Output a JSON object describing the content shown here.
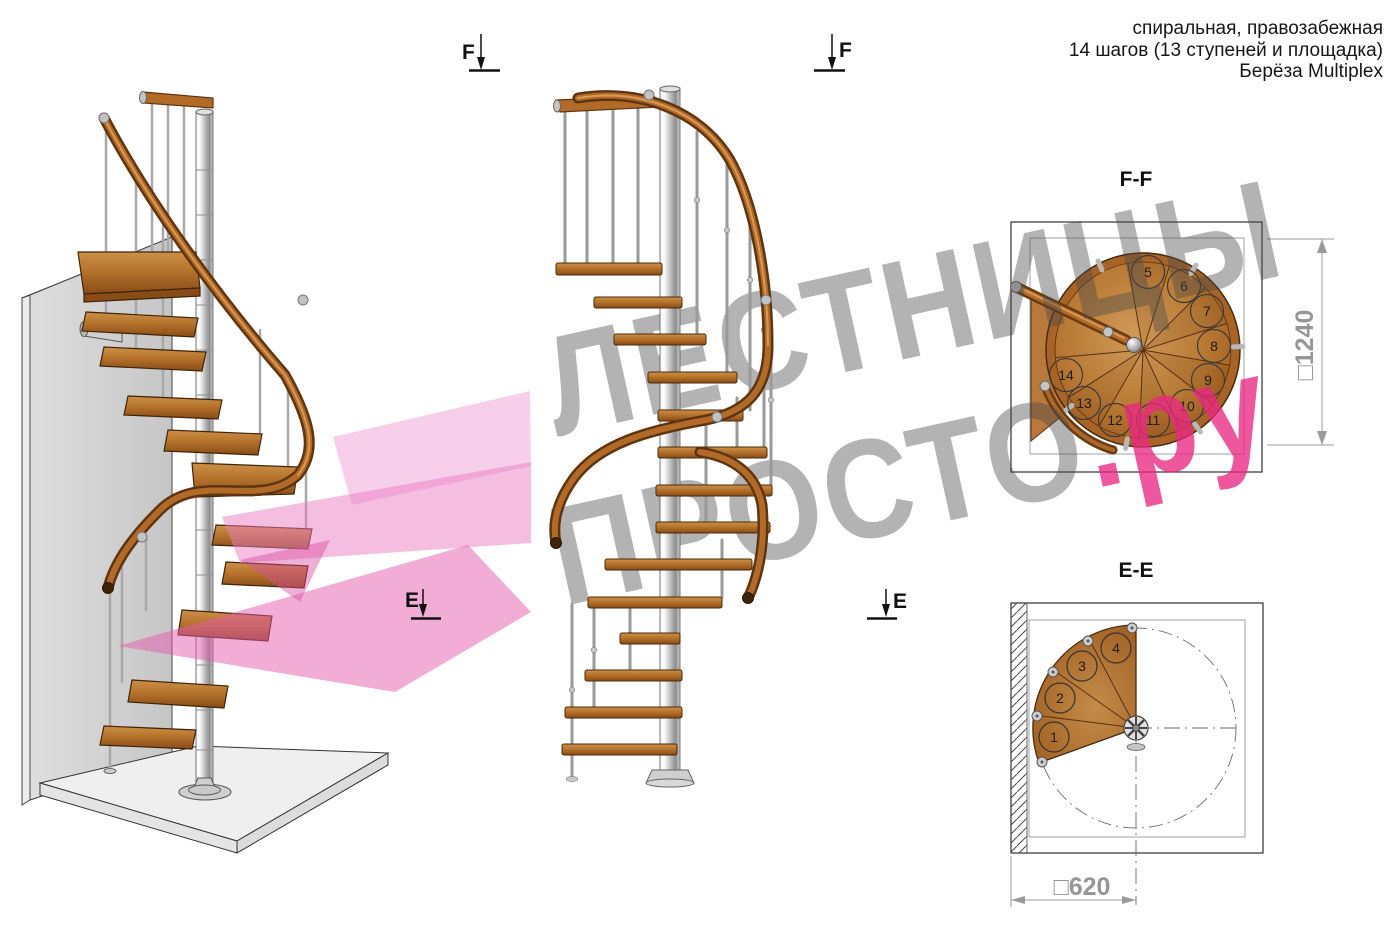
{
  "header": {
    "line1": "спиральная, правозабежная",
    "line2": "14 шагов (13 ступеней и площадка)",
    "line3": "Берёза Multiplex"
  },
  "watermark": {
    "word1": "ЛЕСТНИЦЫ",
    "word2": "ПРОСТО",
    "suffix": ".ру",
    "gray_color": "#4b4b4b",
    "pink_color": "#e92882"
  },
  "sections": {
    "ff": {
      "label": "F-F",
      "dimension": "□1240",
      "steps": [
        "5",
        "6",
        "7",
        "8",
        "9",
        "10",
        "11",
        "12",
        "13",
        "14"
      ]
    },
    "ee": {
      "label": "E-E",
      "dimension": "□620",
      "steps": [
        "1",
        "2",
        "3",
        "4"
      ]
    }
  },
  "markers": {
    "f": "F",
    "e": "E"
  },
  "colors": {
    "wood": "#b5732c",
    "wood_dark": "#6b3a10",
    "handrail": "#b26a28",
    "metal_pole": "#9a9a9a",
    "wall_gray": "#d4d4d4",
    "floor_gray": "#efefef",
    "pink_overlay": "#e45bae",
    "dimension_gray": "#969696",
    "line_black": "#111111"
  }
}
